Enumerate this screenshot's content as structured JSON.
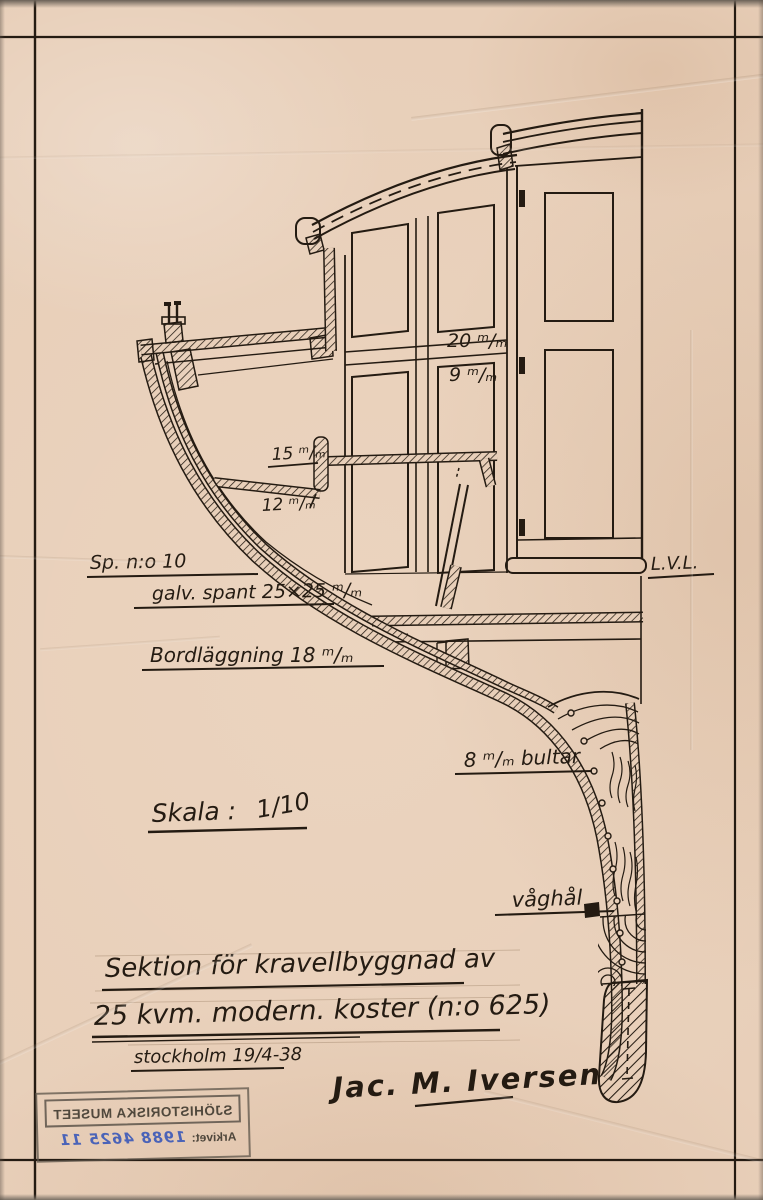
{
  "page": {
    "paper_color": "#e8cfb9",
    "ink_color": "#241b12"
  },
  "labels": {
    "sp_no": "Sp. n:o 10",
    "galv_spant": "galv. spant 25×25 ᵐ/ₘ",
    "bordlaggning": "Bordläggning 18 ᵐ/ₘ",
    "dim_20": "20 ᵐ/ₘ",
    "dim_9": "9 ᵐ/ₘ",
    "dim_15": "15 ᵐ/ₘ",
    "dim_12": "12 ᵐ/ₘ",
    "bultar": "8 ᵐ/ₘ bultar",
    "vaghal": "våghål",
    "lvl": "L.V.L.",
    "skala_label": "Skala :",
    "skala_value": "1/10"
  },
  "title": {
    "line1": "Sektion för kravellbyggnad av",
    "line2": "25 kvm. modern. koster (n:o 625)",
    "place_date": "stockholm 19/4-38",
    "signature": "Jac. M. Iversen"
  },
  "stamp": {
    "museum": "SJÖHISTORISKA MUSEET",
    "archive_label": "Arkivet:",
    "archive_number": "1988 4625 11",
    "ink_color": "#5c544a",
    "number_color": "#4a63b8"
  }
}
